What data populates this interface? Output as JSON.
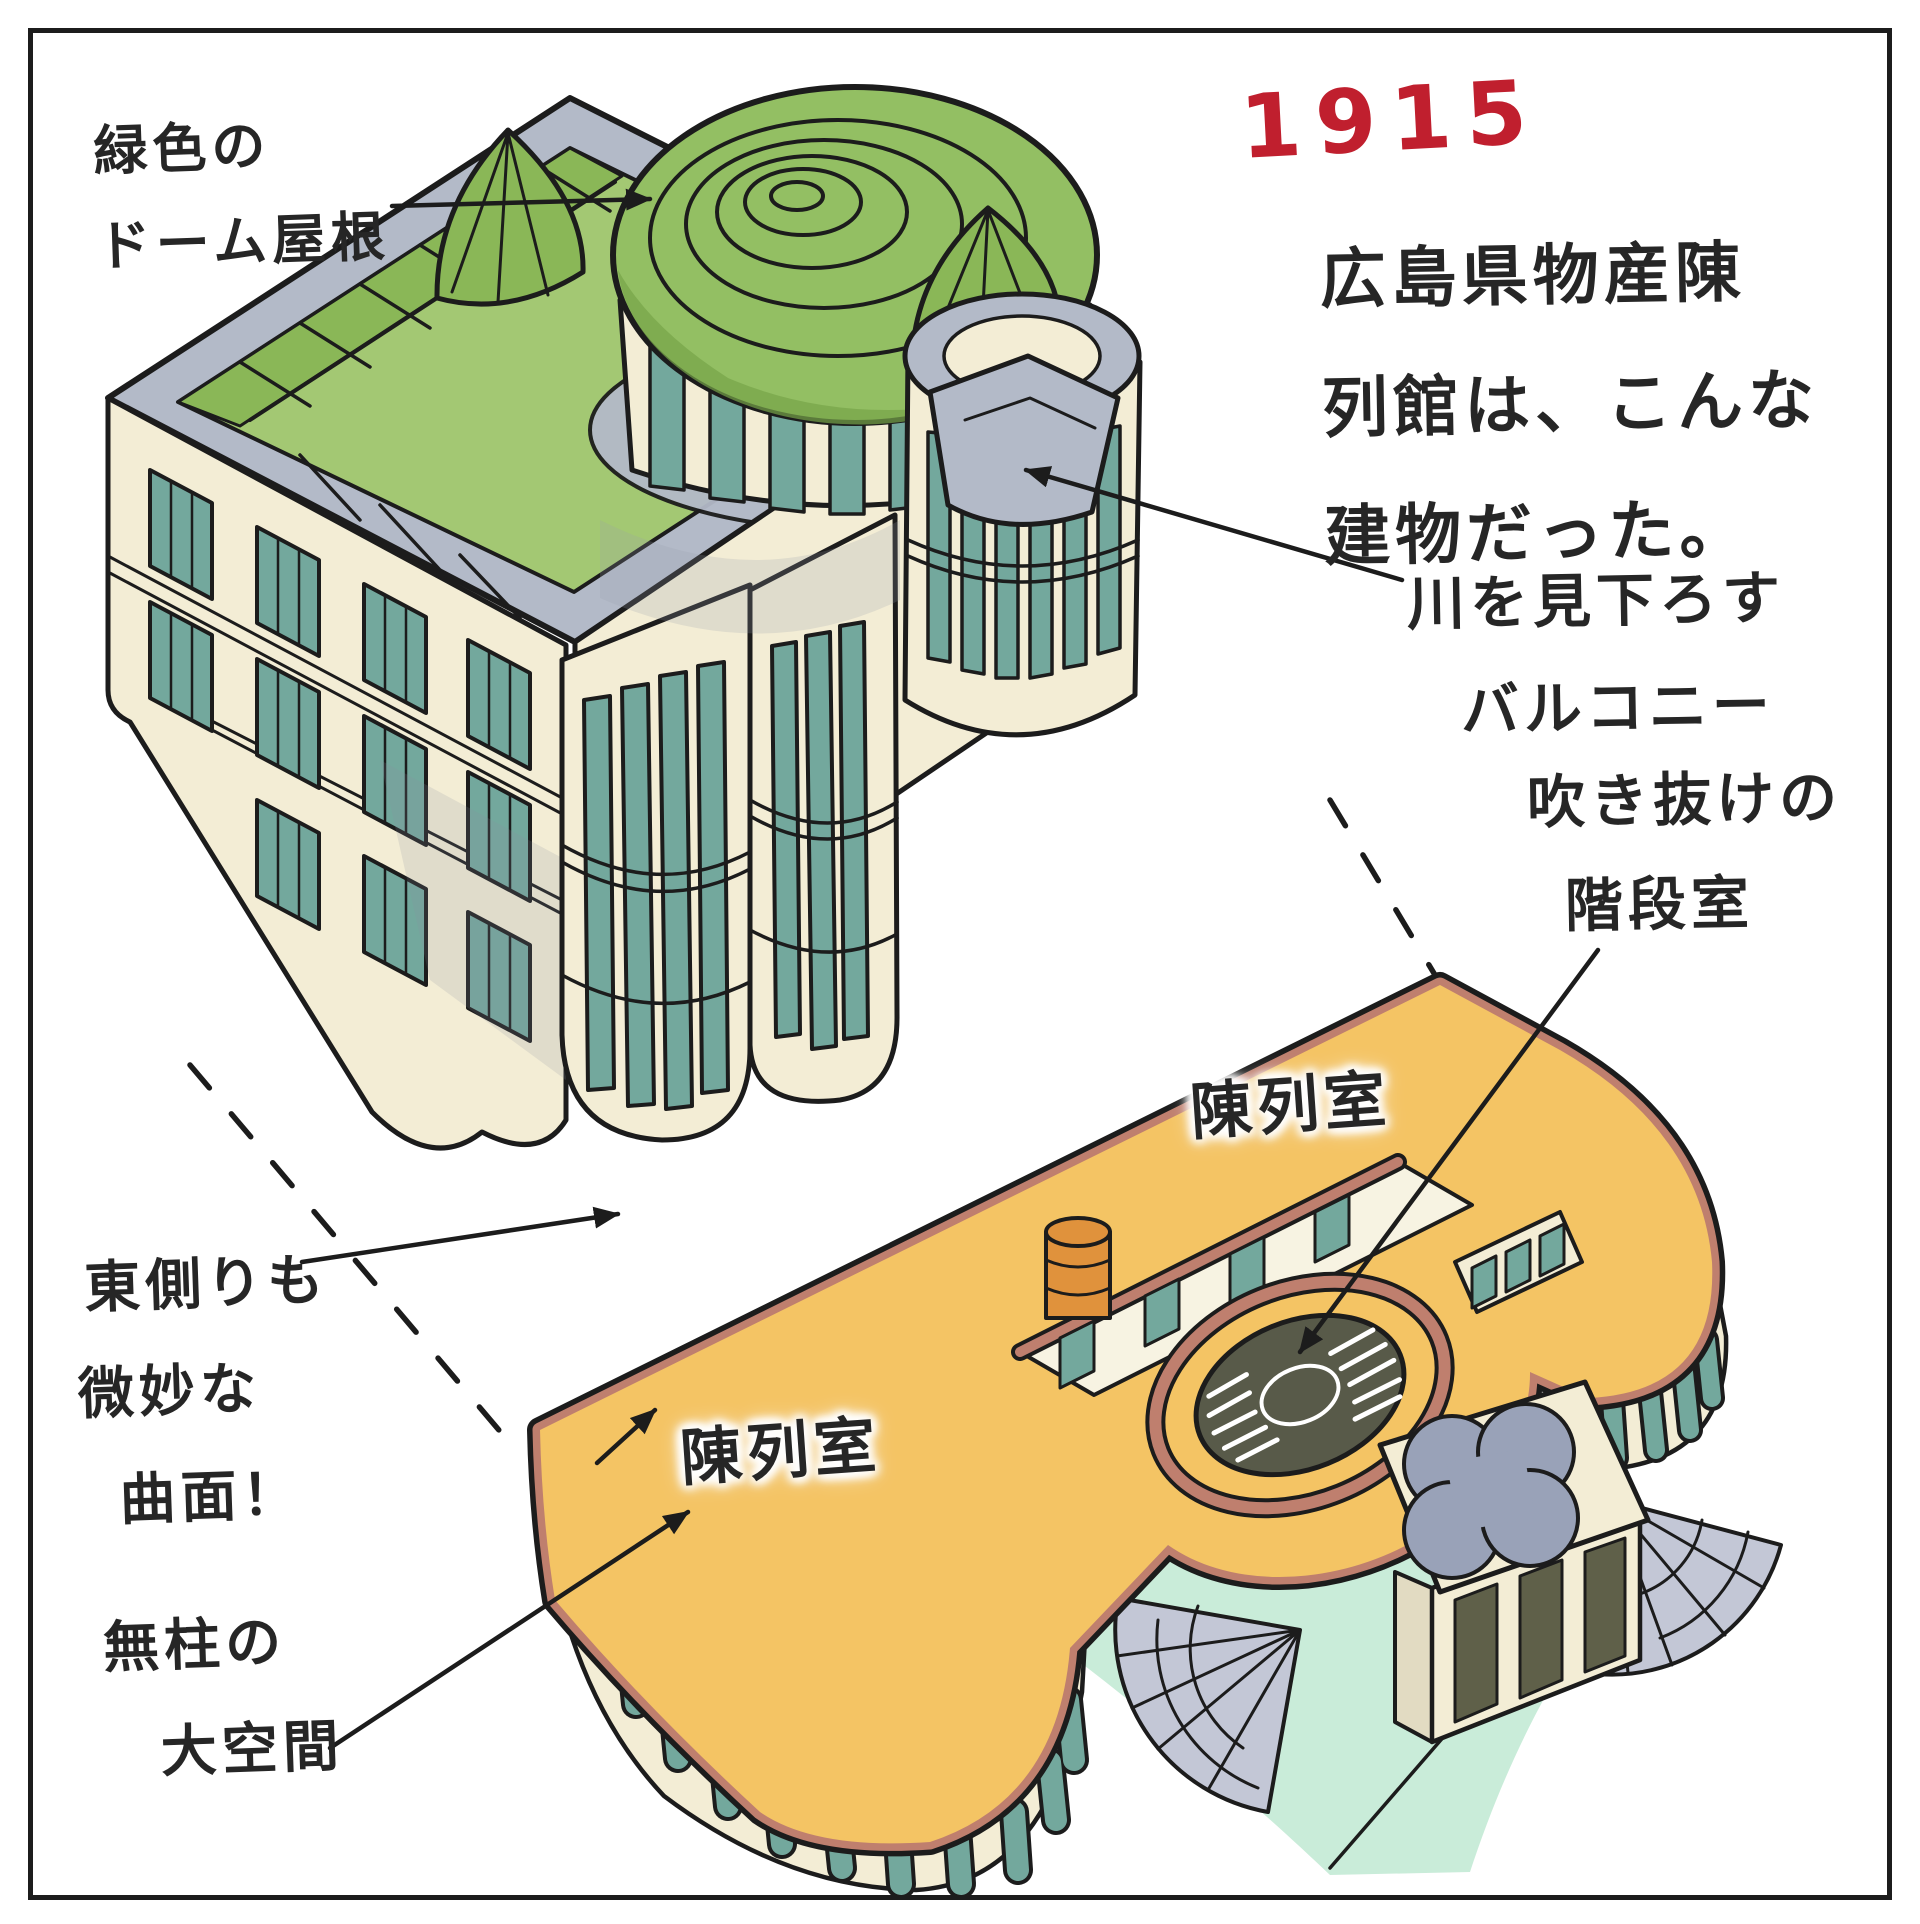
{
  "drawing": {
    "year": "1915",
    "annotations": {
      "dome_label": {
        "lines": [
          "緑色の",
          "ドーム屋根"
        ]
      },
      "intro": {
        "lines": [
          "広島県物産陳",
          "列館は、こんな",
          "建物だった。"
        ]
      },
      "balcony_label": {
        "lines": [
          "川を見下ろす",
          "バルコニー"
        ]
      },
      "stairwell_label": {
        "lines": [
          "吹き抜けの",
          "階段室"
        ]
      },
      "exhibit_room_top": "陳列室",
      "exhibit_room_left": "陳列室",
      "east_side_label": {
        "lines": [
          "東側りも",
          "微妙な",
          "曲面！"
        ]
      },
      "column_free_label": {
        "lines": [
          "無柱の",
          "大空間"
        ]
      }
    },
    "colors": {
      "ink": "#1c1c1c",
      "paper": "#ffffff",
      "accent_red": "#c01f2e",
      "roof_green": "#a3c873",
      "roof_green_dark": "#8ab757",
      "dome_green": "#93bf63",
      "band_gray": "#b3bac8",
      "wall_cream": "#f3edd5",
      "window_teal": "#73a89d",
      "floor_orange": "#f4c464",
      "parapet_salmon": "#bf7f6e",
      "stairwell_gray": "#585a49",
      "stone_gray": "#c3c7d6",
      "ground_mint": "#c9ecd9",
      "cylinder_orange": "#e0923c"
    }
  }
}
